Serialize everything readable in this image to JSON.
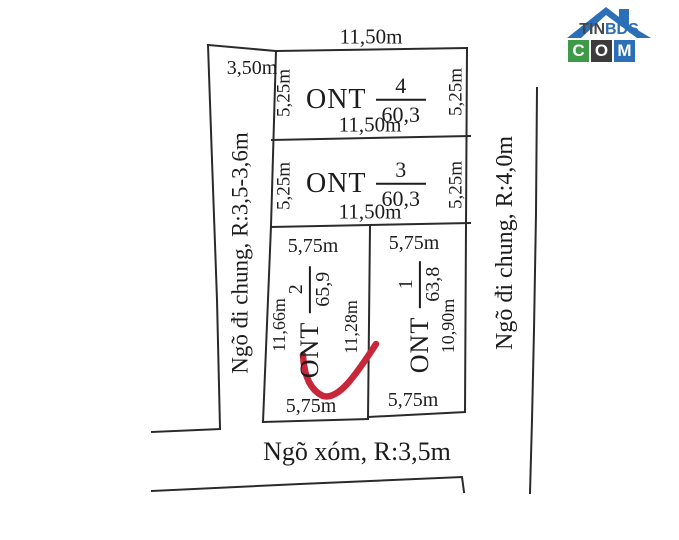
{
  "colors": {
    "line": "#2a2a2a",
    "annotation_red": "#c8273a",
    "logo_blue": "#2b6fb7",
    "logo_green": "#3d9b48",
    "logo_dark": "#3c3c3c"
  },
  "logo": {
    "tin": "TIN",
    "bds": "BDS",
    "com": [
      "C",
      "O",
      "M"
    ]
  },
  "diagram": {
    "top_dimension": "11,50m",
    "corridor_width": "3,50m",
    "left_road": "Ngõ đi chung, R:3,5-3,6m",
    "right_road": "Ngõ đi chung, R:4,0m",
    "bottom_road": "Ngõ xóm, R:3,5m",
    "plots": [
      {
        "code": "ONT",
        "lot": "4",
        "area": "60,3",
        "left": "5,25m",
        "right": "5,25m",
        "bottom": "11,50m"
      },
      {
        "code": "ONT",
        "lot": "3",
        "area": "60,3",
        "left": "5,25m",
        "right": "5,25m",
        "bottom": "11,50m"
      },
      {
        "code": "ONT",
        "lot": "2",
        "area": "65,9",
        "top": "5,75m",
        "left": "11,66m",
        "right": "11,28m",
        "bottom": "5,75m"
      },
      {
        "code": "ONT",
        "lot": "1",
        "area": "63,8",
        "top": "5,75m",
        "right": "10,90m",
        "bottom": "5,75m"
      }
    ]
  }
}
